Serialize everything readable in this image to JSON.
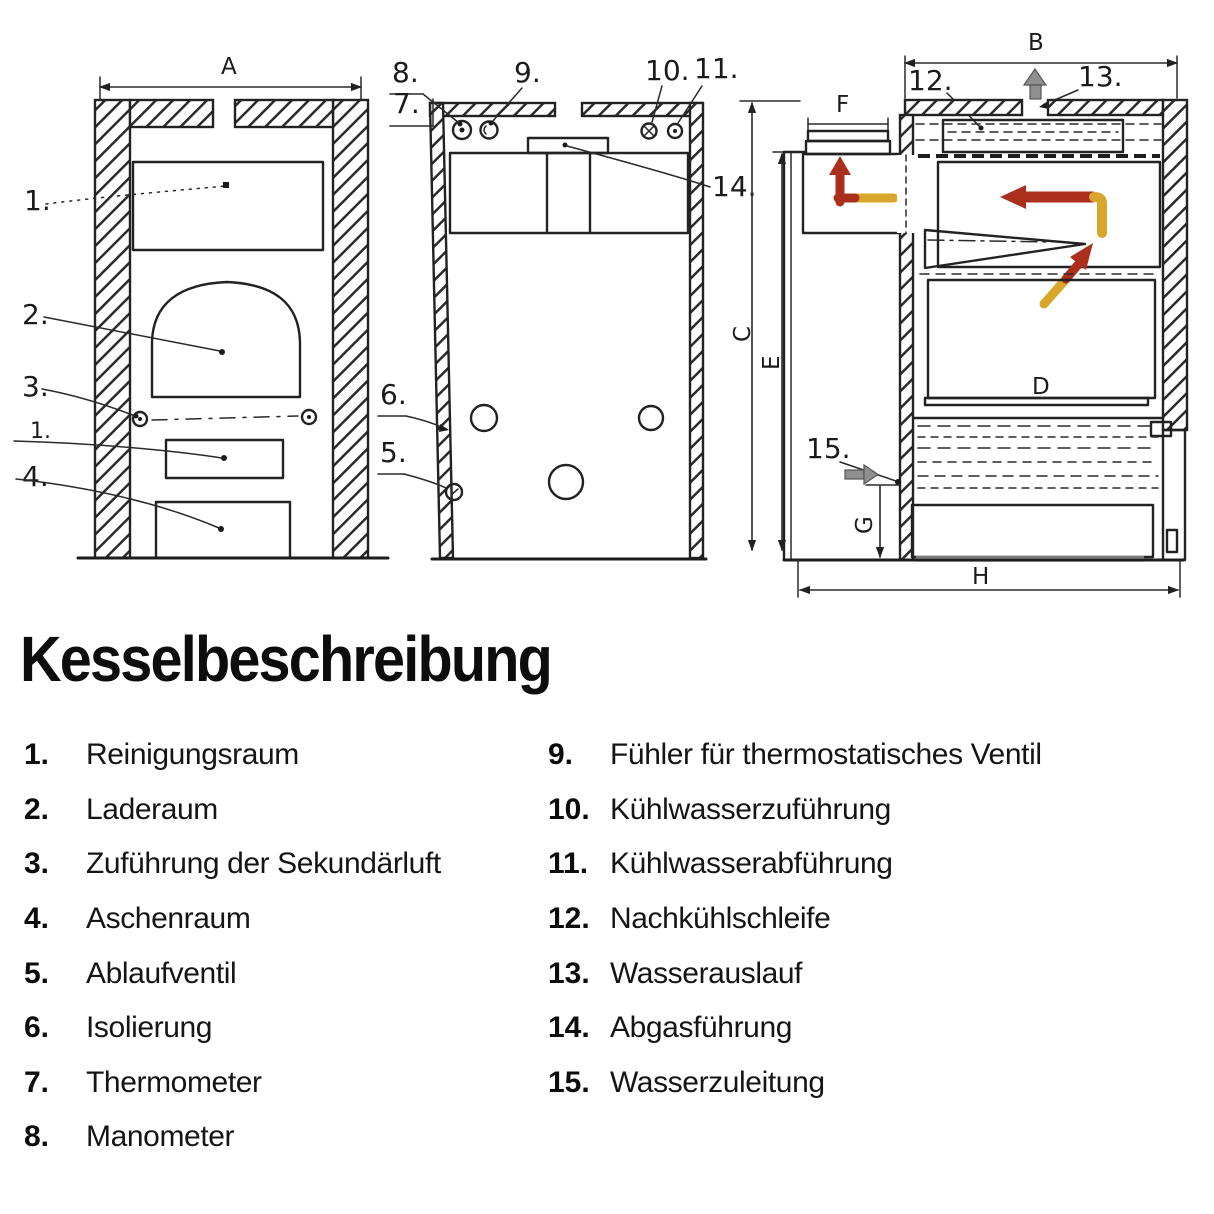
{
  "title": "Kesselbeschreibung",
  "drawings": {
    "dim_labels": {
      "A": "A",
      "B": "B",
      "C": "C",
      "D": "D",
      "E": "E",
      "F": "F",
      "G": "G",
      "H": "H"
    },
    "callouts": {
      "n1a": "1.",
      "n2": "2.",
      "n3": "3.",
      "n1b": "1.",
      "n4": "4.",
      "n5": "5.",
      "n6": "6.",
      "n7": "7.",
      "n8": "8.",
      "n9": "9.",
      "n10": "10.",
      "n11": "11.",
      "n12": "12.",
      "n13": "13.",
      "n14": "14.",
      "n15": "15."
    },
    "colors": {
      "ink": "#222222",
      "hot_flow": "#ab2f1d",
      "warm_flow": "#d7a62b",
      "water_arrow": "#8f8f8f"
    }
  },
  "legend": {
    "left": [
      {
        "num": "1.",
        "label": "Reinigungsraum"
      },
      {
        "num": "2.",
        "label": "Laderaum"
      },
      {
        "num": "3.",
        "label": "Zuführung der Sekundärluft"
      },
      {
        "num": "4.",
        "label": "Aschenraum"
      },
      {
        "num": "5.",
        "label": "Ablaufventil"
      },
      {
        "num": "6.",
        "label": "Isolierung"
      },
      {
        "num": "7.",
        "label": "Thermometer"
      },
      {
        "num": "8.",
        "label": "Manometer"
      }
    ],
    "right": [
      {
        "num": "9.",
        "label": "Fühler für thermostatisches Ventil"
      },
      {
        "num": "10.",
        "label": "Kühlwasserzuführung"
      },
      {
        "num": "11.",
        "label": "Kühlwasserabführung"
      },
      {
        "num": "12.",
        "label": "Nachkühlschleife"
      },
      {
        "num": "13.",
        "label": "Wasserauslauf"
      },
      {
        "num": "14.",
        "label": "Abgasführung"
      },
      {
        "num": "15.",
        "label": "Wasserzuleitung"
      }
    ]
  }
}
